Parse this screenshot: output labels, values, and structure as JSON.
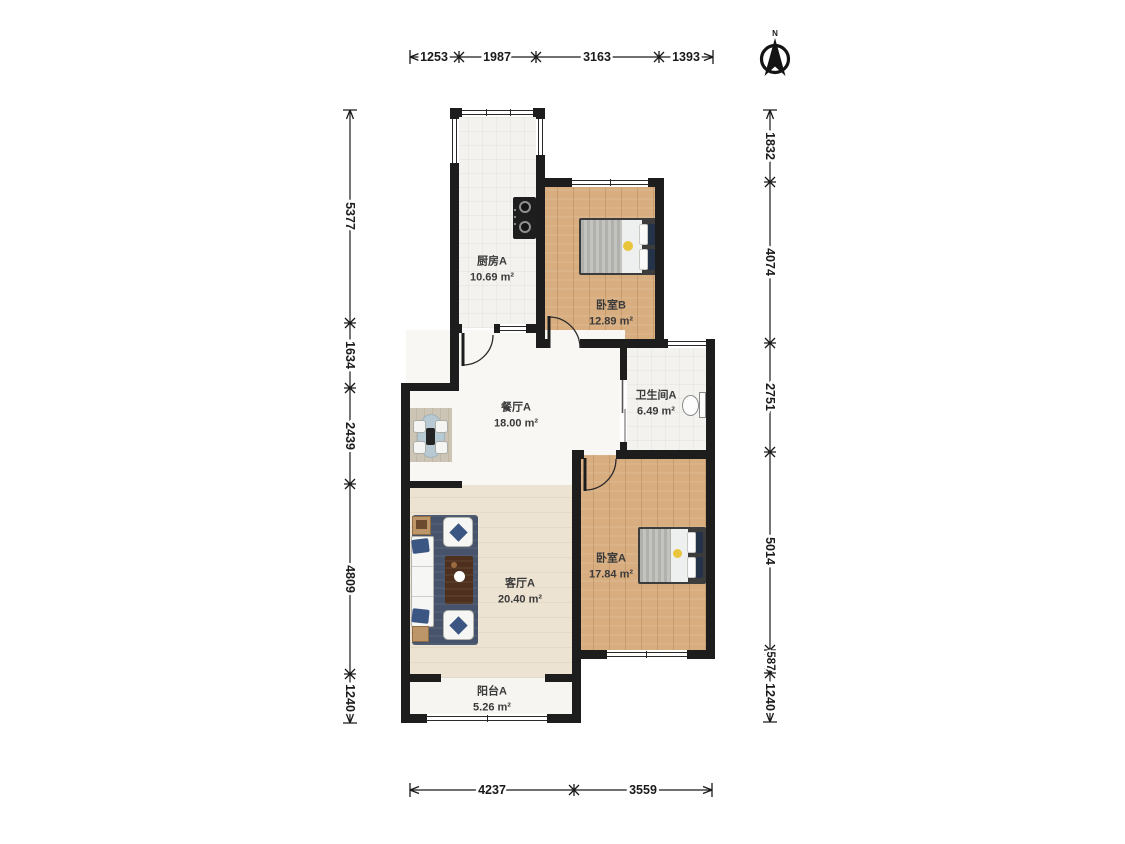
{
  "compass": {
    "label": "N"
  },
  "rooms": {
    "kitchen": {
      "name": "厨房A",
      "area": "10.69 m²"
    },
    "bedroom_b": {
      "name": "卧室B",
      "area": "12.89 m²"
    },
    "dining": {
      "name": "餐厅A",
      "area": "18.00 m²"
    },
    "bathroom": {
      "name": "卫生间A",
      "area": "6.49 m²"
    },
    "living": {
      "name": "客厅A",
      "area": "20.40 m²"
    },
    "bedroom_a": {
      "name": "卧室A",
      "area": "17.84 m²"
    },
    "balcony": {
      "name": "阳台A",
      "area": "5.26 m²"
    }
  },
  "dimensions_mm": {
    "top": [
      "1253",
      "1987",
      "3163",
      "1393"
    ],
    "bottom": [
      "4237",
      "3559"
    ],
    "left": [
      "5377",
      "1634",
      "2439",
      "4809",
      "1240"
    ],
    "right": [
      "1832",
      "4074",
      "2751",
      "5014",
      "587",
      "1240"
    ]
  },
  "colors": {
    "wall": "#1d1d1d",
    "wood_floor": "#d8ad7f",
    "living_floor": "#ece3d2",
    "tile_floor": "#f3f2ef",
    "rug": "#46536b",
    "accent_yellow": "#e9c53c",
    "navy_pillow": "#24324a"
  }
}
